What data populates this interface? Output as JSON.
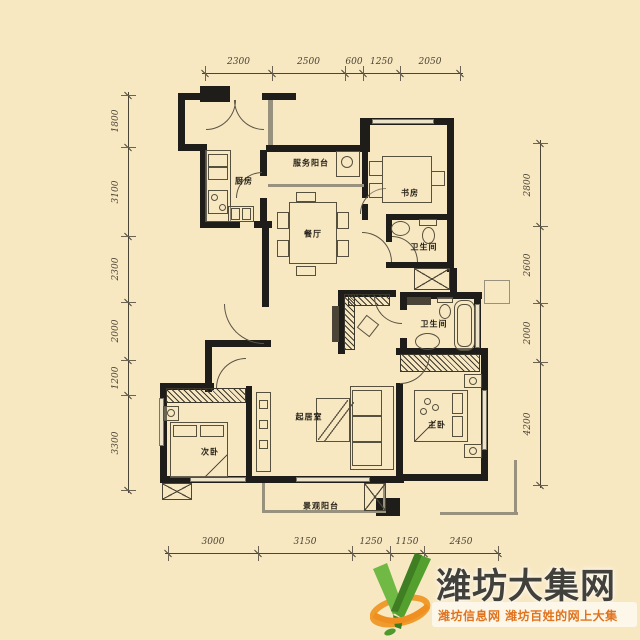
{
  "canvas": {
    "background": "#f8e8c2"
  },
  "floorplan": {
    "rooms": [
      {
        "id": "kitchen",
        "label": "厨房"
      },
      {
        "id": "service-balcony",
        "label": "服务阳台"
      },
      {
        "id": "study",
        "label": "书房"
      },
      {
        "id": "dining",
        "label": "餐厅"
      },
      {
        "id": "bathroom-1",
        "label": "卫生间"
      },
      {
        "id": "bathroom-2",
        "label": "卫生间"
      },
      {
        "id": "living-room",
        "label": "起居室"
      },
      {
        "id": "master-bedroom",
        "label": "主卧"
      },
      {
        "id": "second-bedroom",
        "label": "次卧"
      },
      {
        "id": "view-balcony",
        "label": "景观阳台"
      }
    ],
    "dimensions": {
      "top": [
        "2300",
        "2500",
        "600",
        "1250",
        "2050"
      ],
      "left": [
        "1800",
        "3100",
        "2300",
        "2000",
        "1200",
        "3300"
      ],
      "right": [
        "2800",
        "2600",
        "2000",
        "4200"
      ],
      "bottom": [
        "3000",
        "3150",
        "1250",
        "1150",
        "2450"
      ]
    }
  },
  "watermark": {
    "title": "潍坊大集网",
    "subtitle": "潍坊信息网 潍坊百姓的网上大集",
    "logo_icon": "green-check-logo",
    "colors": {
      "title": "#42403b",
      "subtitle": "#e0731e",
      "logo_green": "#53a02e",
      "logo_orange": "#f09b2d"
    }
  }
}
